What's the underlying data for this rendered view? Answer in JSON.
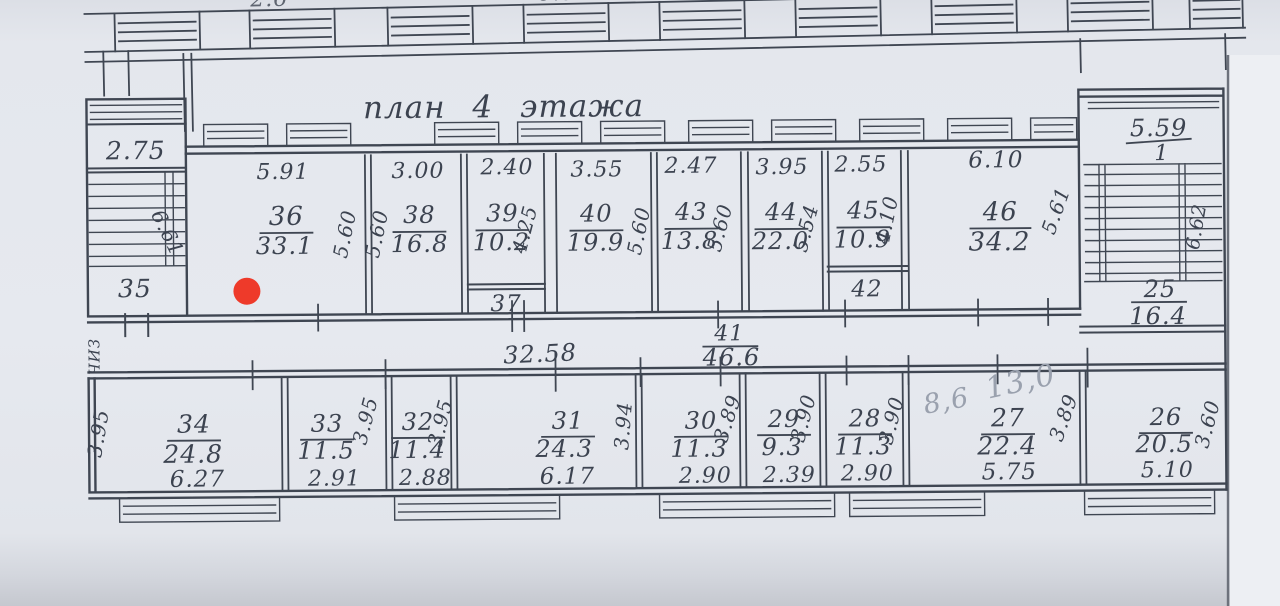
{
  "title": "план 4 этажа",
  "colors": {
    "paper": "#e4e7ed",
    "ink": "#3f4652",
    "pencil": "#9aa1ae",
    "marker_red": "#ee3a2a",
    "scan_edge": "#c5c8cf"
  },
  "marker": {
    "color": "#ee3a2a",
    "room": "36"
  },
  "upper_floor_fragments": {
    "f1": "2.6",
    "f2": "6.89",
    "f3": "2.15",
    "f4": "2.45"
  },
  "left_stair": {
    "width": "2.75",
    "room_number": "35",
    "stair_dim": "6.61",
    "side_annotation": "ЧИЗ"
  },
  "right_stair": {
    "width": "5.59",
    "flight_label": "1",
    "stair_dim": "6.62",
    "room_number": "25",
    "room_area": "16.4"
  },
  "corridor": {
    "length": "32.58",
    "number": "41",
    "area": "46.6"
  },
  "rooms_top": [
    {
      "number": "36",
      "area": "33.1",
      "width": "5.91",
      "side": "5.60"
    },
    {
      "number": "38",
      "area": "16.8",
      "width": "3.00",
      "side": "5.60"
    },
    {
      "number": "39",
      "area": "10.2",
      "width": "2.40",
      "side": "4.25"
    },
    {
      "number": "40",
      "area": "19.9",
      "width": "3.55",
      "side": "5.60"
    },
    {
      "number": "43",
      "area": "13.8",
      "width": "2.47",
      "side": "5.60"
    },
    {
      "number": "44",
      "area": "22.0",
      "width": "3.95",
      "side": "5.54"
    },
    {
      "number": "45",
      "area": "10.9",
      "width": "2.55",
      "side": "4.10"
    },
    {
      "number": "46",
      "area": "34.2",
      "width": "6.10",
      "side": "5.61"
    }
  ],
  "small_rooms": {
    "r37": "37",
    "r42": "42"
  },
  "rooms_bottom": [
    {
      "number": "34",
      "area": "24.8",
      "width": "6.27",
      "side": "3.95"
    },
    {
      "number": "33",
      "area": "11.5",
      "width": "2.91",
      "side": "3.95"
    },
    {
      "number": "32",
      "area": "11.4",
      "width": "2.88",
      "side": "3.95"
    },
    {
      "number": "31",
      "area": "24.3",
      "width": "6.17",
      "side": "3.94"
    },
    {
      "number": "30",
      "area": "11.3",
      "width": "2.90",
      "side": "3.89"
    },
    {
      "number": "29",
      "area": "9.3",
      "width": "2.39",
      "side": "3.90"
    },
    {
      "number": "28",
      "area": "11.3",
      "width": "2.90",
      "side": "3.90"
    },
    {
      "number": "27",
      "area": "22.4",
      "width": "5.75",
      "side": "3.89"
    },
    {
      "number": "26",
      "area": "20.5",
      "width": "5.10",
      "side": "3.60"
    }
  ],
  "pencil_notes": {
    "note1": "8,6",
    "note2": "13,0"
  }
}
